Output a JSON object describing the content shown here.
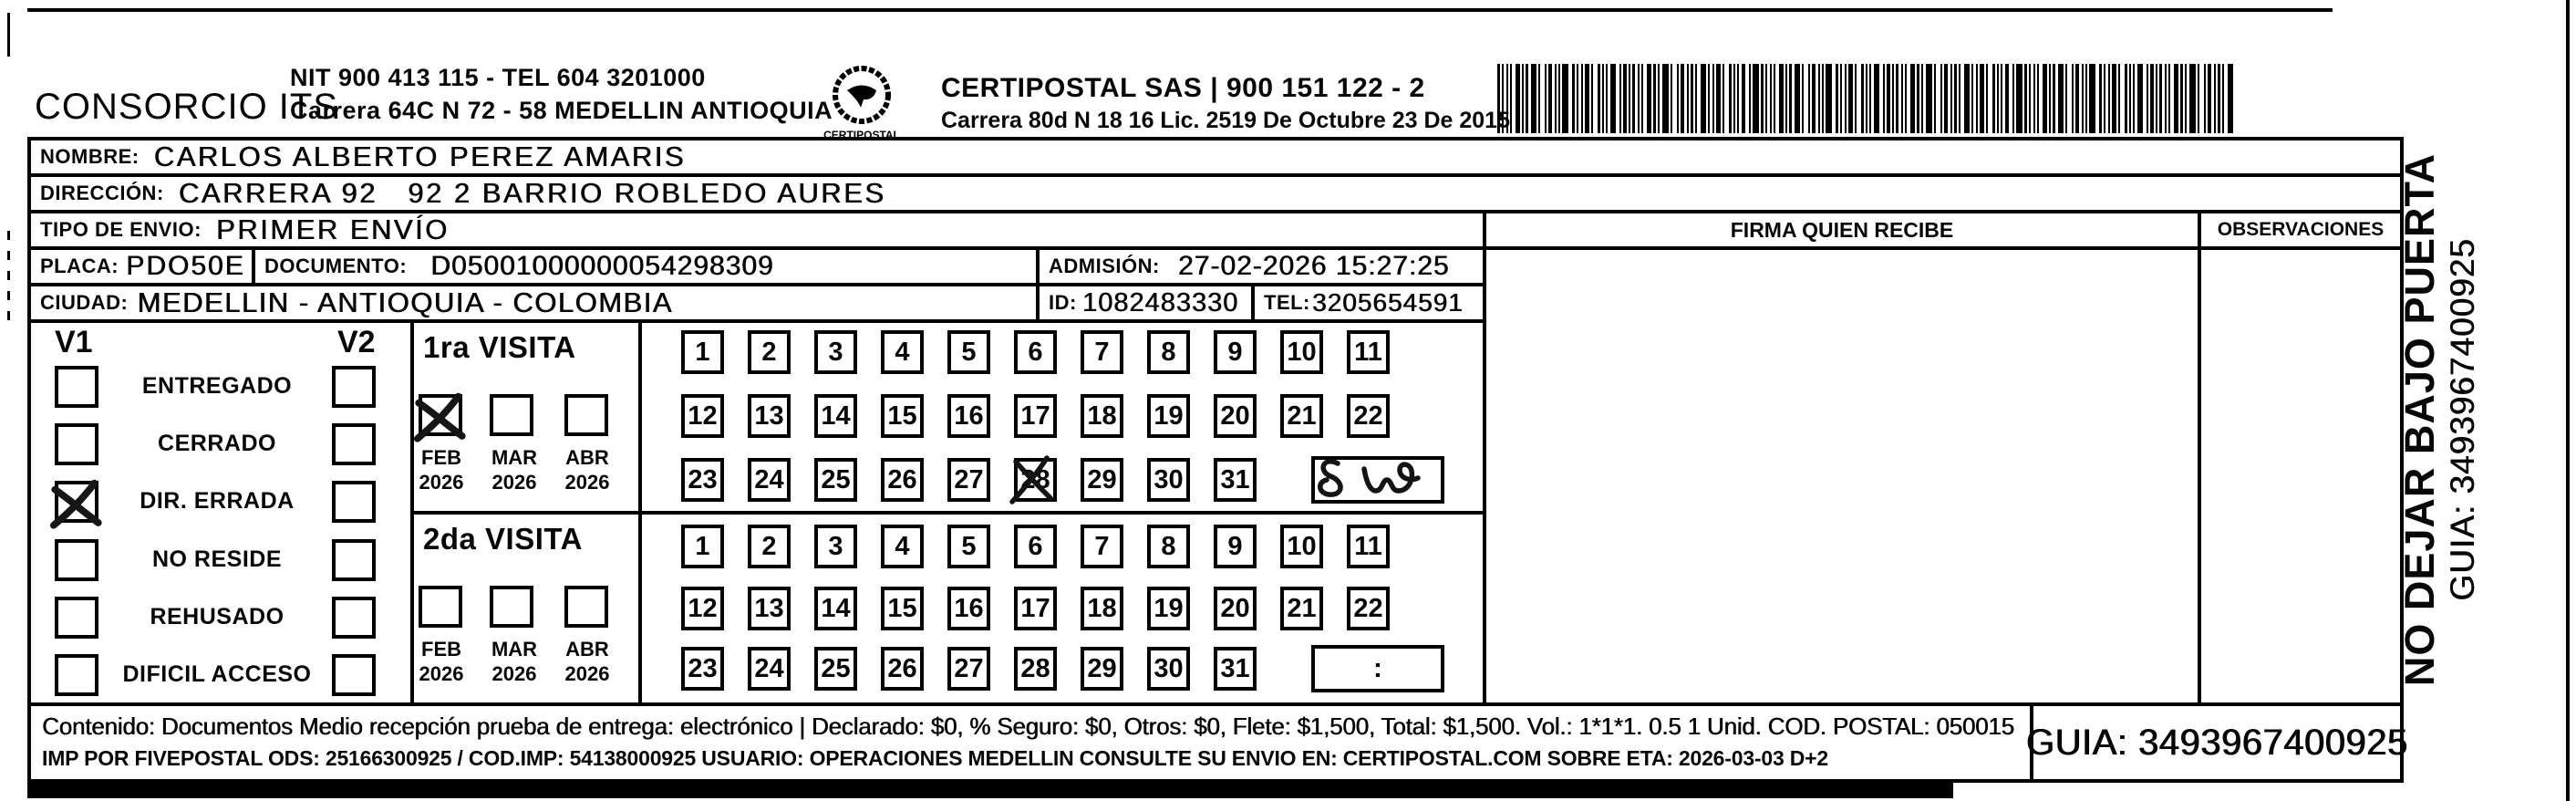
{
  "header": {
    "company": "CONSORCIO ITS",
    "company_info_line1": "NIT 900 413 115 - TEL 604 3201000",
    "company_info_line2": "Carrera 64C N 72 - 58 MEDELLIN ANTIOQUIA",
    "logo_text": "CERTIPOSTAL",
    "carrier_line1": "CERTIPOSTAL SAS | 900 151 122 - 2",
    "carrier_line2": "Carrera 80d N 18 16  Lic. 2519 De Octubre 23 De 2015"
  },
  "recipient": {
    "nombre_label": "NOMBRE:",
    "nombre": "CARLOS ALBERTO PEREZ AMARIS",
    "direccion_label": "DIRECCIÓN:",
    "direccion": "CARRERA 92   92 2 BARRIO ROBLEDO AURES",
    "tipo_label": "TIPO DE ENVIO:",
    "tipo": "PRIMER ENVÍO",
    "placa_label": "PLACA:",
    "placa": "PDO50E",
    "documento_label": "DOCUMENTO:",
    "documento": "D05001000000054298309",
    "admision_label": "ADMISIÓN:",
    "admision": "27-02-2026 15:27:25",
    "ciudad_label": "CIUDAD:",
    "ciudad": "MEDELLIN - ANTIOQUIA - COLOMBIA",
    "id_label": "ID:",
    "id": "1082483330",
    "tel_label": "TEL:",
    "tel": "3205654591"
  },
  "columns": {
    "firma": "FIRMA QUIEN RECIBE",
    "observaciones": "OBSERVACIONES"
  },
  "status_panel": {
    "v1": "V1",
    "v2": "V2",
    "options": [
      {
        "label": "ENTREGADO",
        "v1_checked": false,
        "v2_checked": false
      },
      {
        "label": "CERRADO",
        "v1_checked": false,
        "v2_checked": false
      },
      {
        "label": "DIR. ERRADA",
        "v1_checked": true,
        "v2_checked": false
      },
      {
        "label": "NO RESIDE",
        "v1_checked": false,
        "v2_checked": false
      },
      {
        "label": "REHUSADO",
        "v1_checked": false,
        "v2_checked": false
      },
      {
        "label": "DIFICIL ACCESO",
        "v1_checked": false,
        "v2_checked": false
      }
    ]
  },
  "visits": [
    {
      "title": "1ra VISITA",
      "months": [
        {
          "month": "FEB",
          "year": "2026",
          "checked": true
        },
        {
          "month": "MAR",
          "year": "2026",
          "checked": false
        },
        {
          "month": "ABR",
          "year": "2026",
          "checked": false
        }
      ],
      "day_rows": [
        [
          1,
          2,
          3,
          4,
          5,
          6,
          7,
          8,
          9,
          10,
          11
        ],
        [
          12,
          13,
          14,
          15,
          16,
          17,
          18,
          19,
          20,
          21,
          22
        ],
        [
          23,
          24,
          25,
          26,
          27,
          28,
          29,
          30,
          31
        ]
      ],
      "crossed_out_day": 28,
      "extra_box_text": "",
      "handwritten_note": "scribble (8 w)"
    },
    {
      "title": "2da VISITA",
      "months": [
        {
          "month": "FEB",
          "year": "2026",
          "checked": false
        },
        {
          "month": "MAR",
          "year": "2026",
          "checked": false
        },
        {
          "month": "ABR",
          "year": "2026",
          "checked": false
        }
      ],
      "day_rows": [
        [
          1,
          2,
          3,
          4,
          5,
          6,
          7,
          8,
          9,
          10,
          11
        ],
        [
          12,
          13,
          14,
          15,
          16,
          17,
          18,
          19,
          20,
          21,
          22
        ],
        [
          23,
          24,
          25,
          26,
          27,
          28,
          29,
          30,
          31
        ]
      ],
      "crossed_out_day": null,
      "extra_box_text": ":",
      "handwritten_note": ""
    }
  ],
  "footer": {
    "line1": "Contenido: Documentos Medio recepción prueba de entrega: electrónico | Declarado: $0, % Seguro: $0, Otros: $0, Flete: $1,500, Total: $1,500. Vol.: 1*1*1. 0.5  1 Unid. COD. POSTAL: 050015",
    "line2": "IMP POR FIVEPOSTAL ODS: 25166300925 / COD.IMP: 54138000925 USUARIO: OPERACIONES MEDELLIN CONSULTE SU ENVIO EN: CERTIPOSTAL.COM SOBRE ETA: 2026-03-03 D+2",
    "guia": "GUIA: 3493967400925"
  },
  "side_note": {
    "line1": "NO DEJAR BAJO PUERTA",
    "line2": "GUIA: 3493967400925"
  }
}
